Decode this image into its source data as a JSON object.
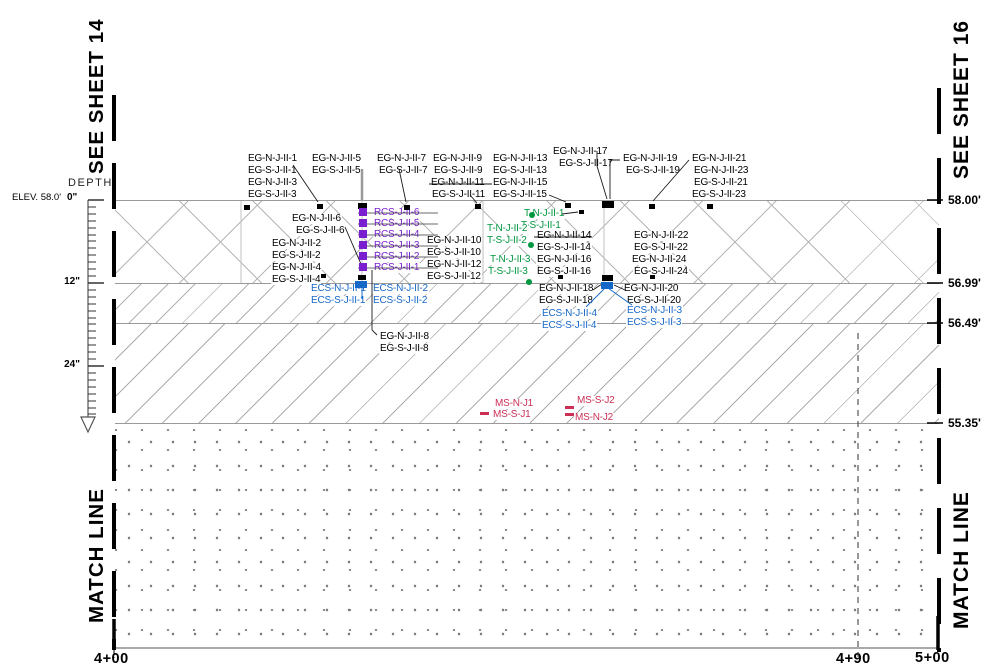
{
  "drawing": {
    "sheet_ref_left": "SEE SHEET 14",
    "sheet_ref_right": "SEE SHEET 16",
    "match_line_left": "MATCH LINE",
    "match_line_right": "MATCH LINE",
    "depth": {
      "title": "DEPTH",
      "elev_note": "ELEV. 58.0'",
      "tick0": "0\"",
      "tick12": "12\"",
      "tick24": "24\""
    },
    "elevations": {
      "e1": "58.00'",
      "e2": "56.99'",
      "e3": "56.49'",
      "e4": "55.35'"
    },
    "stations": {
      "s1": "4+00",
      "s2": "4+90",
      "s3": "5+00"
    }
  },
  "colors": {
    "eg_black": "#000000",
    "rcs_purple": "#7a1fd0",
    "t_green": "#00973f",
    "ecs_blue": "#1668c8",
    "ms_red": "#cc2f55",
    "hatch_gray": "#b2b2b2"
  },
  "labels": {
    "eg": [
      "EG-N-J-II-1",
      "EG-S-J-II-1",
      "EG-N-J-II-3",
      "EG-S-J-II-3",
      "EG-N-J-II-5",
      "EG-S-J-II-5",
      "EG-N-J-II-7",
      "EG-S-J-II-7",
      "EG-N-J-II-9",
      "EG-S-J-II-9",
      "EG-N-J-II-11",
      "EG-S-J-II-11",
      "EG-N-J-II-13",
      "EG-S-J-II-13",
      "EG-N-J-II-15",
      "EG-S-J-II-15",
      "EG-N-J-II-17",
      "EG-S-J-II-17",
      "EG-N-J-II-19",
      "EG-S-J-II-19",
      "EG-N-J-II-21",
      "EG-N-J-II-23",
      "EG-S-J-II-21",
      "EG-S-J-II-23",
      "EG-N-J-II-6",
      "EG-S-J-II-6",
      "EG-N-J-II-2",
      "EG-S-J-II-2",
      "EG-N-J-II-4",
      "EG-S-J-II-4",
      "EG-N-J-II-10",
      "EG-S-J-II-10",
      "EG-N-J-II-12",
      "EG-S-J-II-12",
      "EG-N-J-II-14",
      "EG-S-J-II-14",
      "EG-N-J-II-16",
      "EG-S-J-II-16",
      "EG-N-J-II-22",
      "EG-S-J-II-22",
      "EG-N-J-II-24",
      "EG-S-J-II-24",
      "EG-N-J-II-18",
      "EG-S-J-II-18",
      "EG-N-J-II-20",
      "EG-S-J-II-20",
      "EG-N-J-II-8",
      "EG-S-J-II-8"
    ],
    "rcs": [
      "RCS-J-II-6",
      "RCS-J-II-5",
      "RCS-J-II-4",
      "RCS-J-II-3",
      "RCS-J-II-2",
      "RCS-J-II-1"
    ],
    "t": [
      "T-N-J-II-1",
      "T-S-J-II-1",
      "T-N-J-II-2",
      "T-S-J-II-2",
      "T-N-J-II-3",
      "T-S-J-II-3"
    ],
    "ecs": [
      "ECS-N-J-II-1",
      "ECS-S-J-II-1",
      "ECS-N-J-II-2",
      "ECS-S-J-II-2",
      "ECS-N-J-II-4",
      "ECS-S-J-II-4",
      "ECS-N-J-II-3",
      "ECS-S-J-II-3"
    ],
    "ms": [
      "MS-N-J1",
      "MS-S-J1",
      "MS-S-J2",
      "MS-N-J2"
    ]
  }
}
